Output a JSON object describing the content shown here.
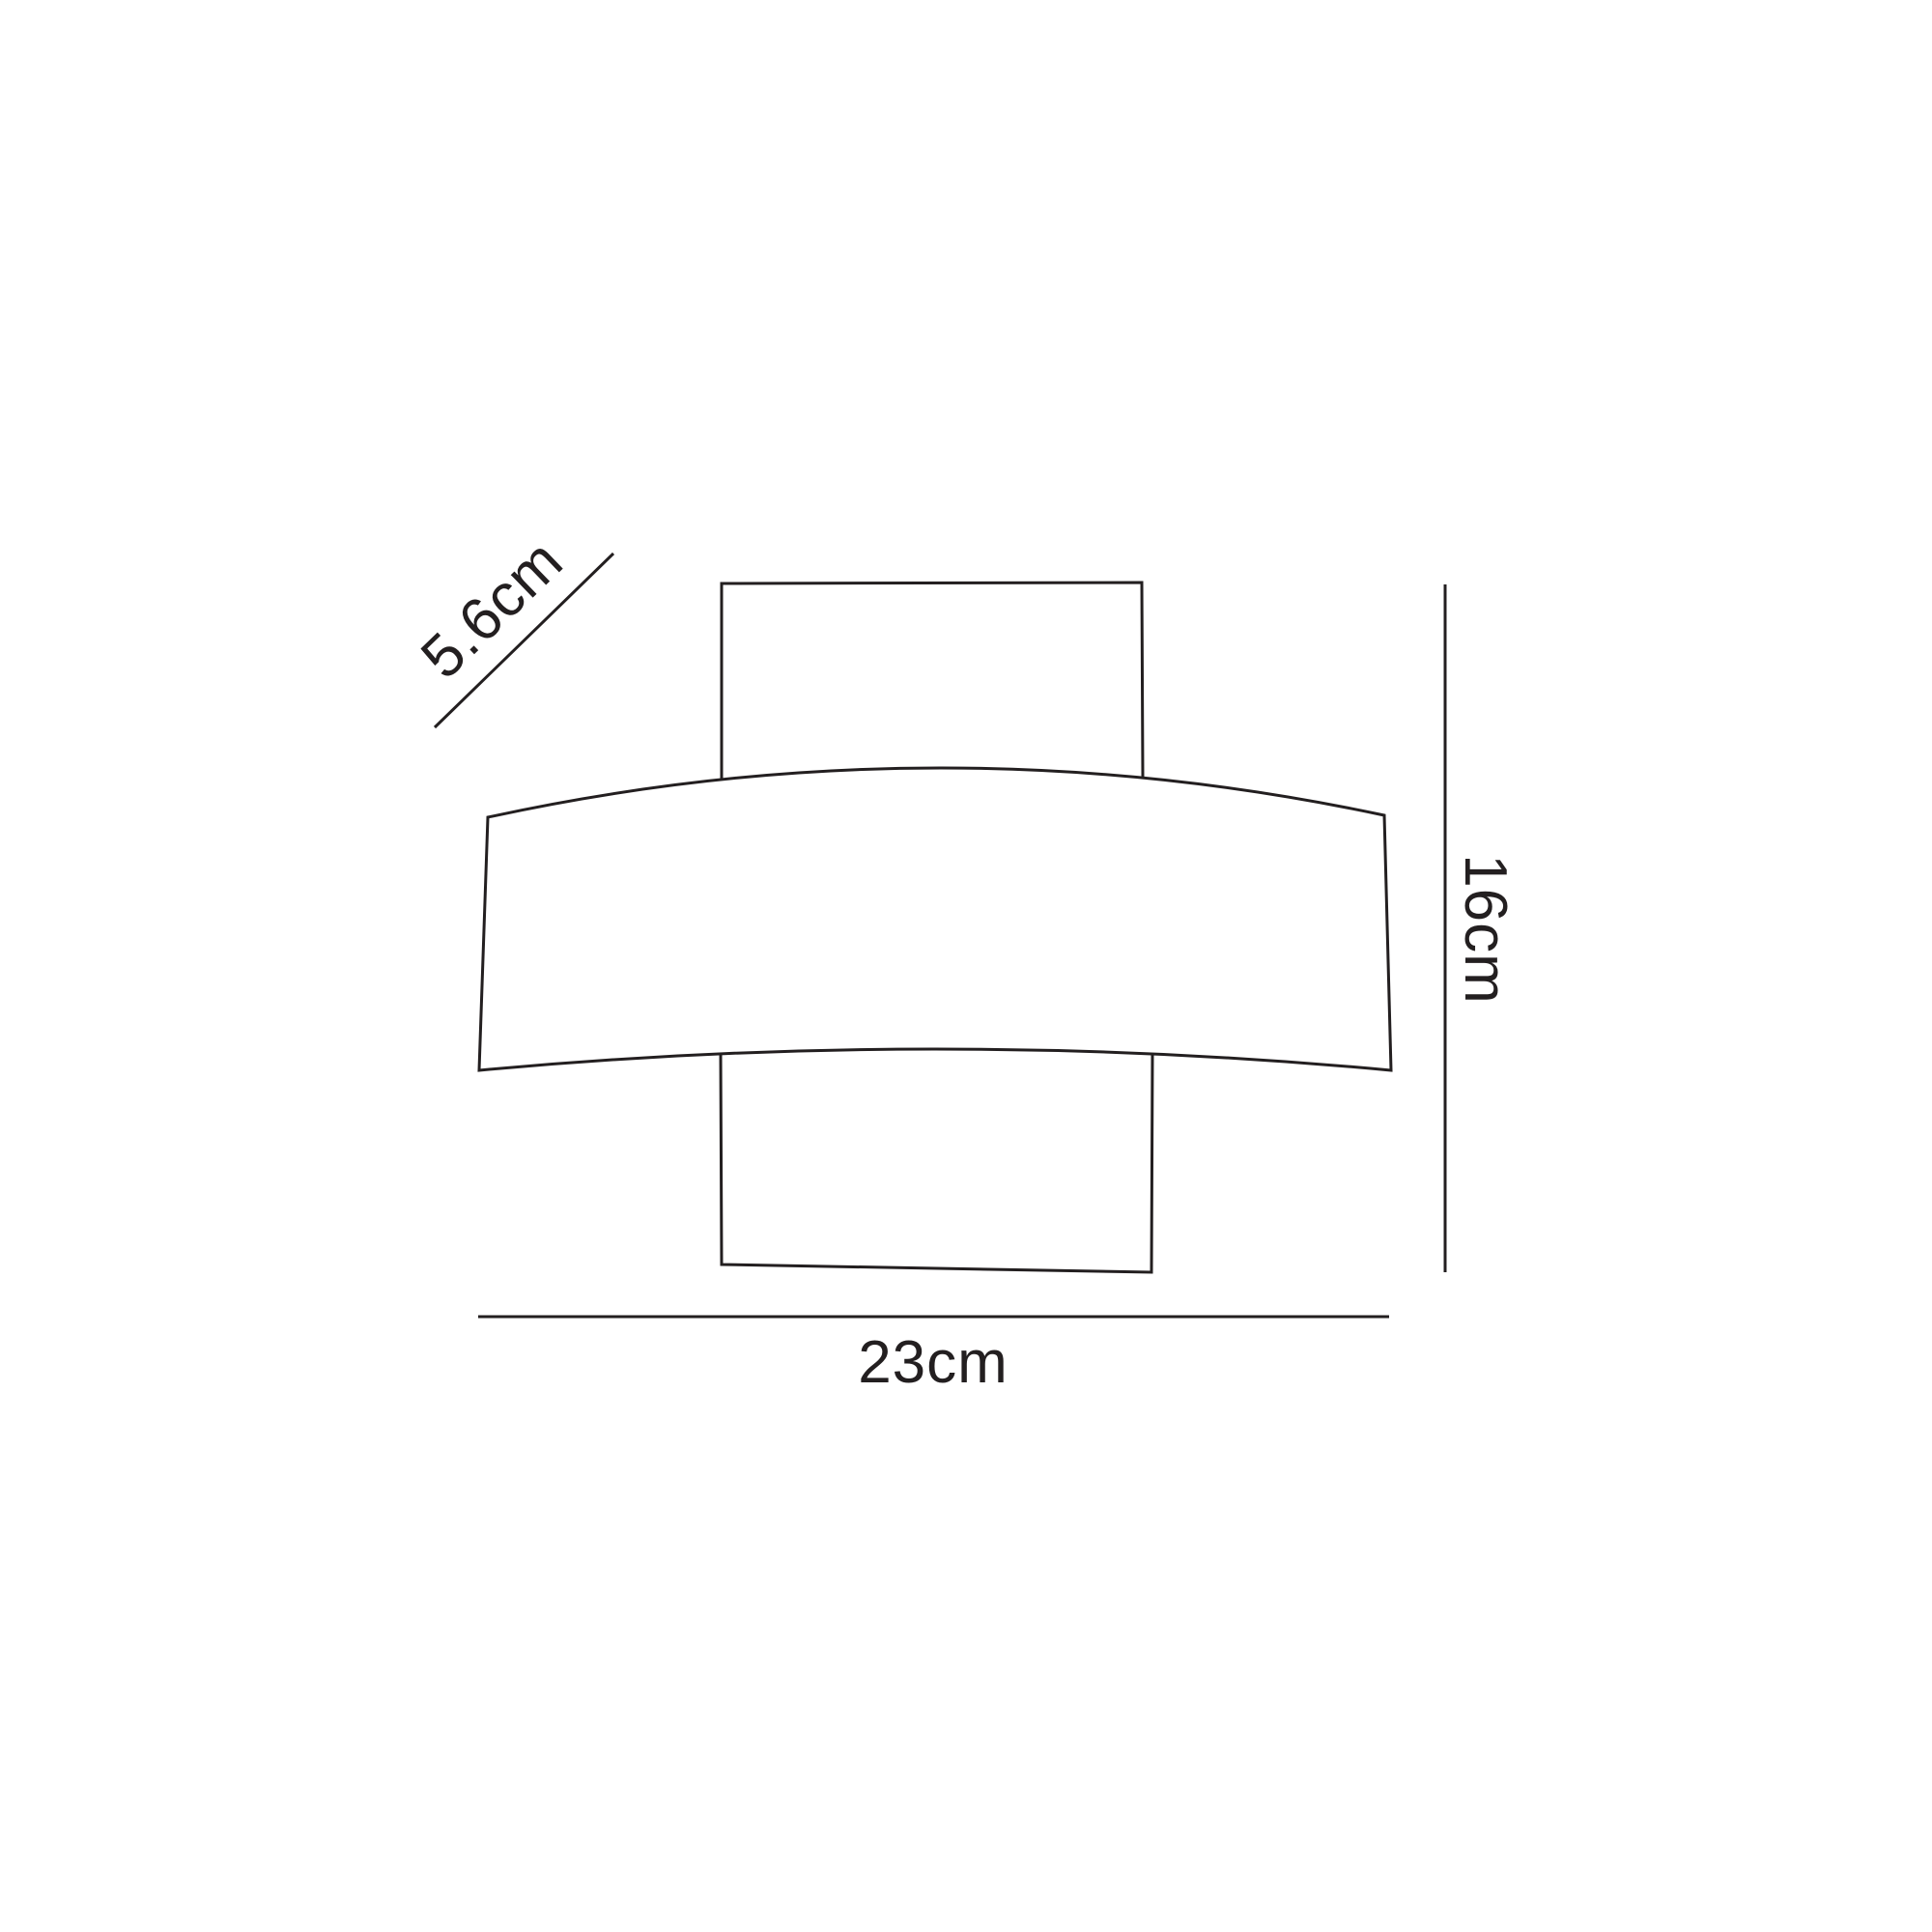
{
  "diagram": {
    "labels": {
      "depth": "5.6cm",
      "height": "16cm",
      "width": "23cm"
    },
    "colors": {
      "line": "#231f20",
      "text": "#231f20",
      "background": "#ffffff"
    }
  }
}
